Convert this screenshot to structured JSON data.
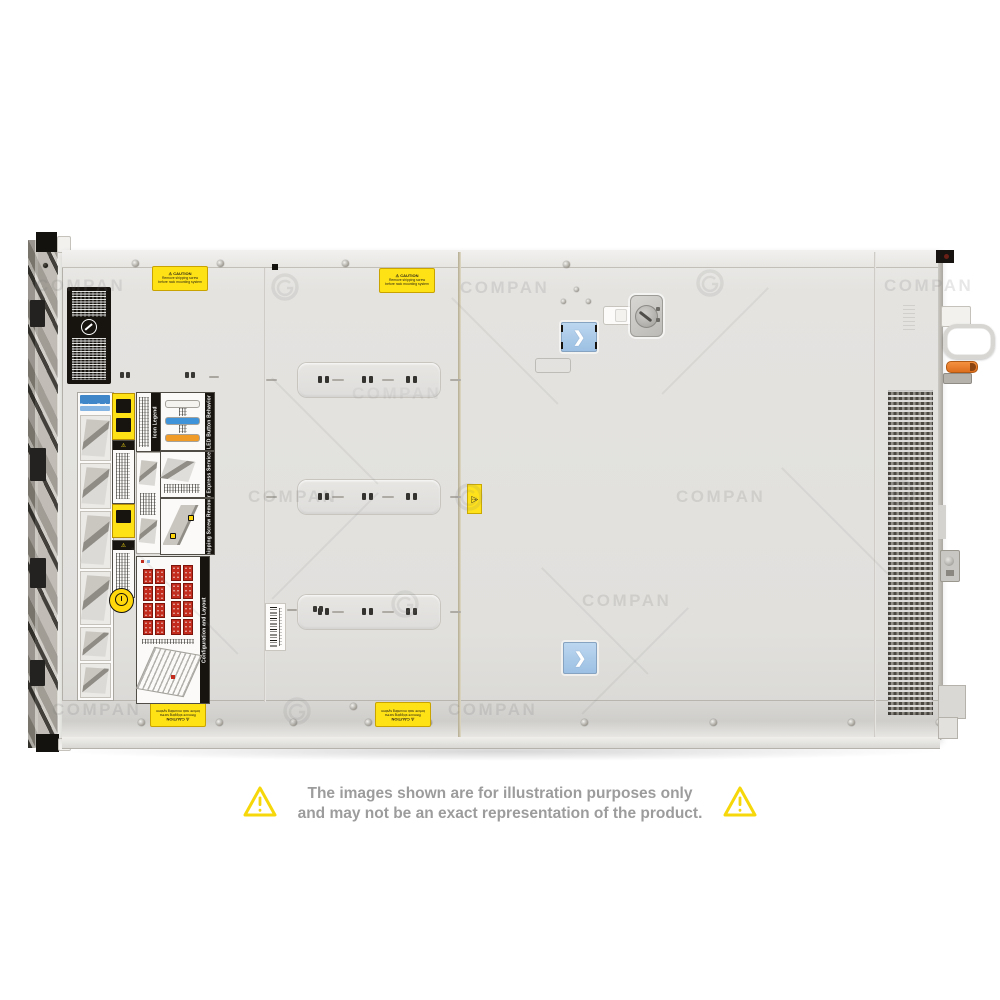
{
  "watermark": {
    "text": "COMPAN"
  },
  "disclaimer": {
    "line1": "The images shown are for illustration purposes only",
    "line2": "and may not be an exact representation of the product."
  },
  "server": {
    "caution_sticker": {
      "title": "⚠ CAUTION",
      "line1": "Remove shipping screw",
      "line2": "before rack mounting system"
    },
    "latch_chevron": "❯",
    "warning_glyph": "⚠",
    "labels": {
      "system_tasks": "System Tasks",
      "icon_legend": "Icon Legend",
      "led_button_behavior": "LED Button Behavior",
      "rear_express_service_tag": "Rear Express Service Tag",
      "shipping_screw_removal": "Shipping Screw Removal",
      "warning": "WARNING",
      "caution": "CAUTION",
      "configuration_and_layout": "Configuration and Layout"
    },
    "colors": {
      "chassis": "#e3e2df",
      "latch_blue": "#a9c9e9",
      "label_yellow": "#ffe215",
      "drive_red": "#c32b1c",
      "accent_orange": "#e87a22",
      "disclaimer_yellow": "#f6d70a"
    }
  }
}
